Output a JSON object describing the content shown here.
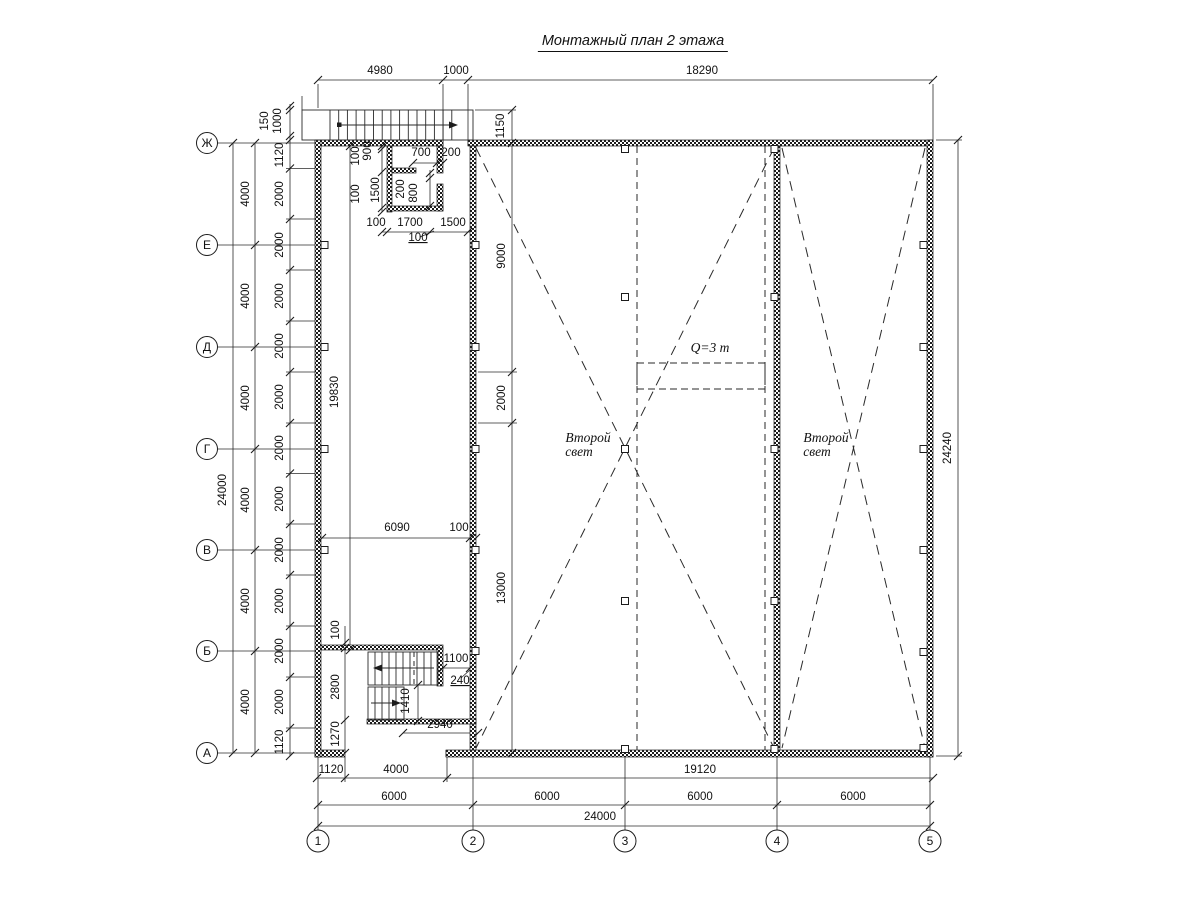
{
  "title": "Монтажный план 2 этажа",
  "drawing": {
    "axis_columns": [
      {
        "label": "1",
        "x": 318
      },
      {
        "label": "2",
        "x": 473
      },
      {
        "label": "3",
        "x": 625
      },
      {
        "label": "4",
        "x": 777
      },
      {
        "label": "5",
        "x": 930
      }
    ],
    "axis_rows": [
      {
        "label": "Ж",
        "y": 143
      },
      {
        "label": "Е",
        "y": 245
      },
      {
        "label": "Д",
        "y": 347
      },
      {
        "label": "Г",
        "y": 449
      },
      {
        "label": "В",
        "y": 550
      },
      {
        "label": "Б",
        "y": 651
      },
      {
        "label": "А",
        "y": 753
      }
    ],
    "notes": [
      {
        "text": "Q=3 т",
        "x": 710,
        "y": 352
      },
      {
        "text": "Второй",
        "x": 588,
        "y": 442
      },
      {
        "text": "свет",
        "x": 579,
        "y": 456
      },
      {
        "text": "Второй",
        "x": 826,
        "y": 442
      },
      {
        "text": "свет",
        "x": 817,
        "y": 456
      }
    ],
    "dimensions": [
      {
        "t": "4980",
        "x": 380,
        "y": 74
      },
      {
        "t": "1000",
        "x": 456,
        "y": 74
      },
      {
        "t": "18290",
        "x": 702,
        "y": 74
      },
      {
        "t": "150",
        "x": 268,
        "y": 121,
        "r": 90
      },
      {
        "t": "1000",
        "x": 281,
        "y": 121,
        "r": 90
      },
      {
        "t": "1150",
        "x": 504,
        "y": 126,
        "r": 90
      },
      {
        "t": "24000",
        "x": 226,
        "y": 490,
        "r": 90
      },
      {
        "t": "4000",
        "x": 249,
        "y": 194,
        "r": 90
      },
      {
        "t": "4000",
        "x": 249,
        "y": 296,
        "r": 90
      },
      {
        "t": "4000",
        "x": 249,
        "y": 398,
        "r": 90
      },
      {
        "t": "4000",
        "x": 249,
        "y": 500,
        "r": 90
      },
      {
        "t": "4000",
        "x": 249,
        "y": 601,
        "r": 90
      },
      {
        "t": "4000",
        "x": 249,
        "y": 702,
        "r": 90
      },
      {
        "t": "1120",
        "x": 283,
        "y": 155,
        "r": 90
      },
      {
        "t": "2000",
        "x": 283,
        "y": 194,
        "r": 90
      },
      {
        "t": "2000",
        "x": 283,
        "y": 245,
        "r": 90
      },
      {
        "t": "2000",
        "x": 283,
        "y": 296,
        "r": 90
      },
      {
        "t": "2000",
        "x": 283,
        "y": 346,
        "r": 90
      },
      {
        "t": "2000",
        "x": 283,
        "y": 397,
        "r": 90
      },
      {
        "t": "2000",
        "x": 283,
        "y": 448,
        "r": 90
      },
      {
        "t": "2000",
        "x": 283,
        "y": 499,
        "r": 90
      },
      {
        "t": "2000",
        "x": 283,
        "y": 550,
        "r": 90
      },
      {
        "t": "2000",
        "x": 283,
        "y": 601,
        "r": 90
      },
      {
        "t": "2000",
        "x": 283,
        "y": 651,
        "r": 90
      },
      {
        "t": "2000",
        "x": 283,
        "y": 702,
        "r": 90
      },
      {
        "t": "1120",
        "x": 283,
        "y": 742,
        "r": 90
      },
      {
        "t": "24240",
        "x": 951,
        "y": 448,
        "r": 90
      },
      {
        "t": "100",
        "x": 359,
        "y": 156,
        "r": 90
      },
      {
        "t": "900",
        "x": 371,
        "y": 151,
        "r": 90
      },
      {
        "t": "700",
        "x": 421,
        "y": 156
      },
      {
        "t": "200",
        "x": 451,
        "y": 156
      },
      {
        "t": "100",
        "x": 359,
        "y": 194,
        "r": 90
      },
      {
        "t": "1500",
        "x": 379,
        "y": 190,
        "r": 90
      },
      {
        "t": "200",
        "x": 404,
        "y": 189,
        "r": 90
      },
      {
        "t": "800",
        "x": 417,
        "y": 193,
        "r": 90
      },
      {
        "t": "100",
        "x": 376,
        "y": 226
      },
      {
        "t": "1700",
        "x": 410,
        "y": 226
      },
      {
        "t": "1500",
        "x": 453,
        "y": 226
      },
      {
        "t": "100",
        "x": 418,
        "y": 241,
        "u": true
      },
      {
        "t": "19830",
        "x": 338,
        "y": 392,
        "r": 90
      },
      {
        "t": "9000",
        "x": 505,
        "y": 256,
        "r": 90
      },
      {
        "t": "2000",
        "x": 505,
        "y": 398,
        "r": 90
      },
      {
        "t": "13000",
        "x": 505,
        "y": 588,
        "r": 90
      },
      {
        "t": "6090",
        "x": 397,
        "y": 531
      },
      {
        "t": "100",
        "x": 459,
        "y": 531
      },
      {
        "t": "100",
        "x": 339,
        "y": 630,
        "r": 90
      },
      {
        "t": "2800",
        "x": 339,
        "y": 687,
        "r": 90
      },
      {
        "t": "1270",
        "x": 339,
        "y": 734,
        "r": 90
      },
      {
        "t": "1100",
        "x": 456,
        "y": 662
      },
      {
        "t": "240",
        "x": 460,
        "y": 684,
        "u": true
      },
      {
        "t": "1410",
        "x": 409,
        "y": 701,
        "r": 90
      },
      {
        "t": "2940",
        "x": 440,
        "y": 728
      },
      {
        "t": "1120",
        "x": 331,
        "y": 773
      },
      {
        "t": "4000",
        "x": 396,
        "y": 773
      },
      {
        "t": "19120",
        "x": 700,
        "y": 773
      },
      {
        "t": "6000",
        "x": 394,
        "y": 800
      },
      {
        "t": "6000",
        "x": 547,
        "y": 800
      },
      {
        "t": "6000",
        "x": 700,
        "y": 800
      },
      {
        "t": "6000",
        "x": 853,
        "y": 800
      },
      {
        "t": "24000",
        "x": 600,
        "y": 820
      }
    ]
  }
}
